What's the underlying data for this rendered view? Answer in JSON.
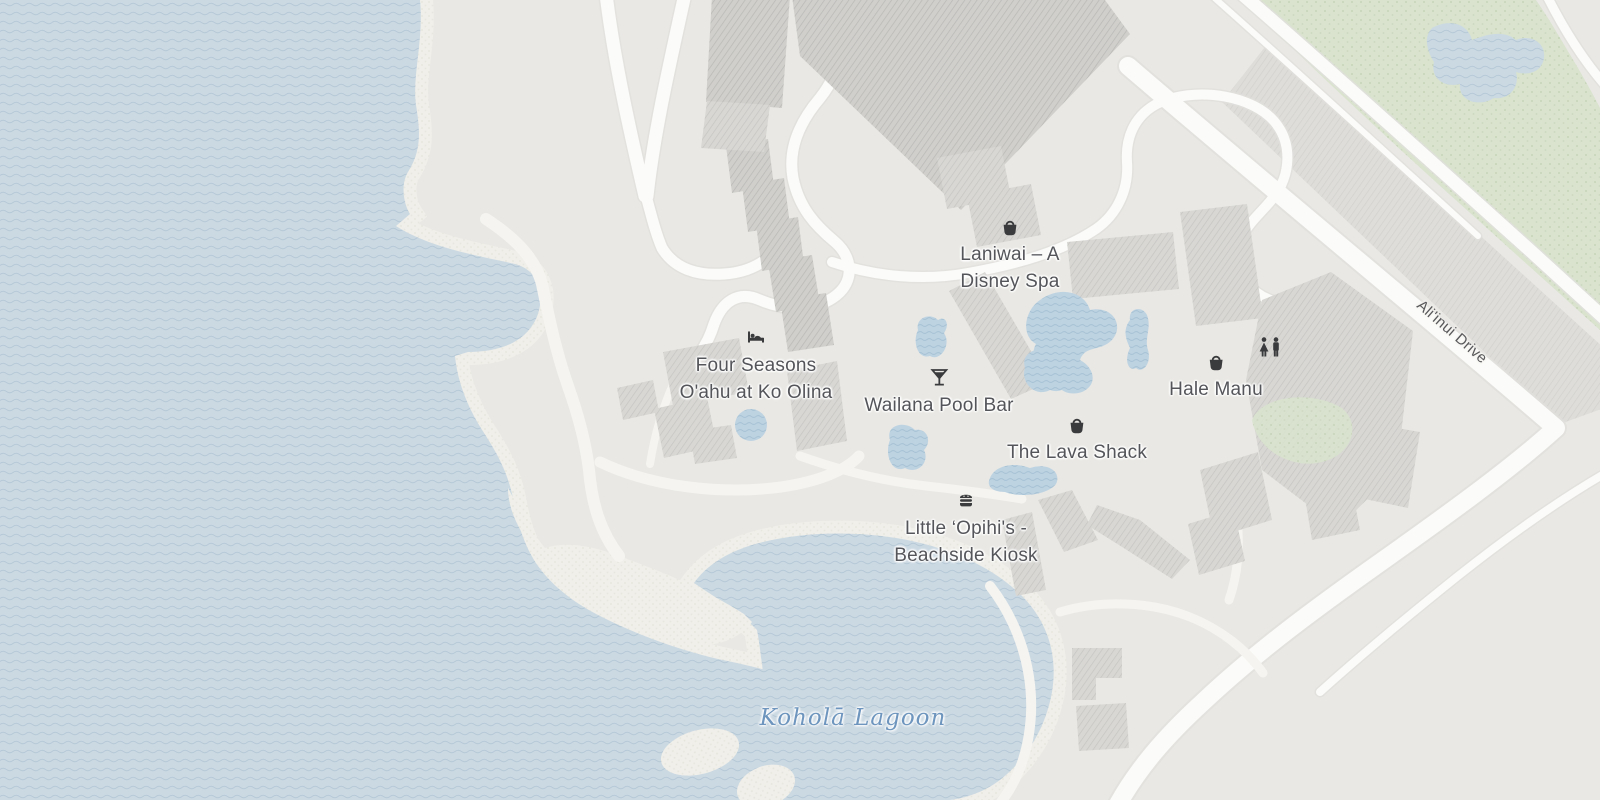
{
  "map": {
    "kind": "street-map-resort-area",
    "pois": [
      {
        "name": "Four Seasons O'ahu at Ko Olina",
        "icon": "hotel-bed-icon",
        "category": "hotel"
      },
      {
        "name": "Laniwai – A Disney Spa",
        "icon": "shopping-bag-icon",
        "category": "spa"
      },
      {
        "name": "Wailana Pool Bar",
        "icon": "cocktail-icon",
        "category": "bar"
      },
      {
        "name": "The Lava Shack",
        "icon": "shopping-bag-icon",
        "category": "shop"
      },
      {
        "name": "Hale Manu",
        "icon": "shopping-bag-icon",
        "category": "shop"
      },
      {
        "name": "Little ‘Opihi's - Beachside Kiosk",
        "icon": "food-kiosk-icon",
        "category": "restaurant"
      }
    ],
    "standalone_icons": [
      {
        "icon": "restroom-icon"
      }
    ],
    "labels": {
      "water": "Koholā Lagoon",
      "road": "Ali'inui Drive"
    },
    "colors": {
      "land": "#e9e8e4",
      "water": "#cbd9e3",
      "water_line": "#b6c9d6",
      "sand": "#f0efe9",
      "park": "#d9e3ce",
      "building": "#d8d7d4",
      "building_dark": "#d0cfcc",
      "road": "#fbfbf9",
      "poi_text": "#54555a",
      "water_text": "#6d95bd",
      "road_text": "#58585a",
      "icon": "#3a3b3d"
    }
  }
}
